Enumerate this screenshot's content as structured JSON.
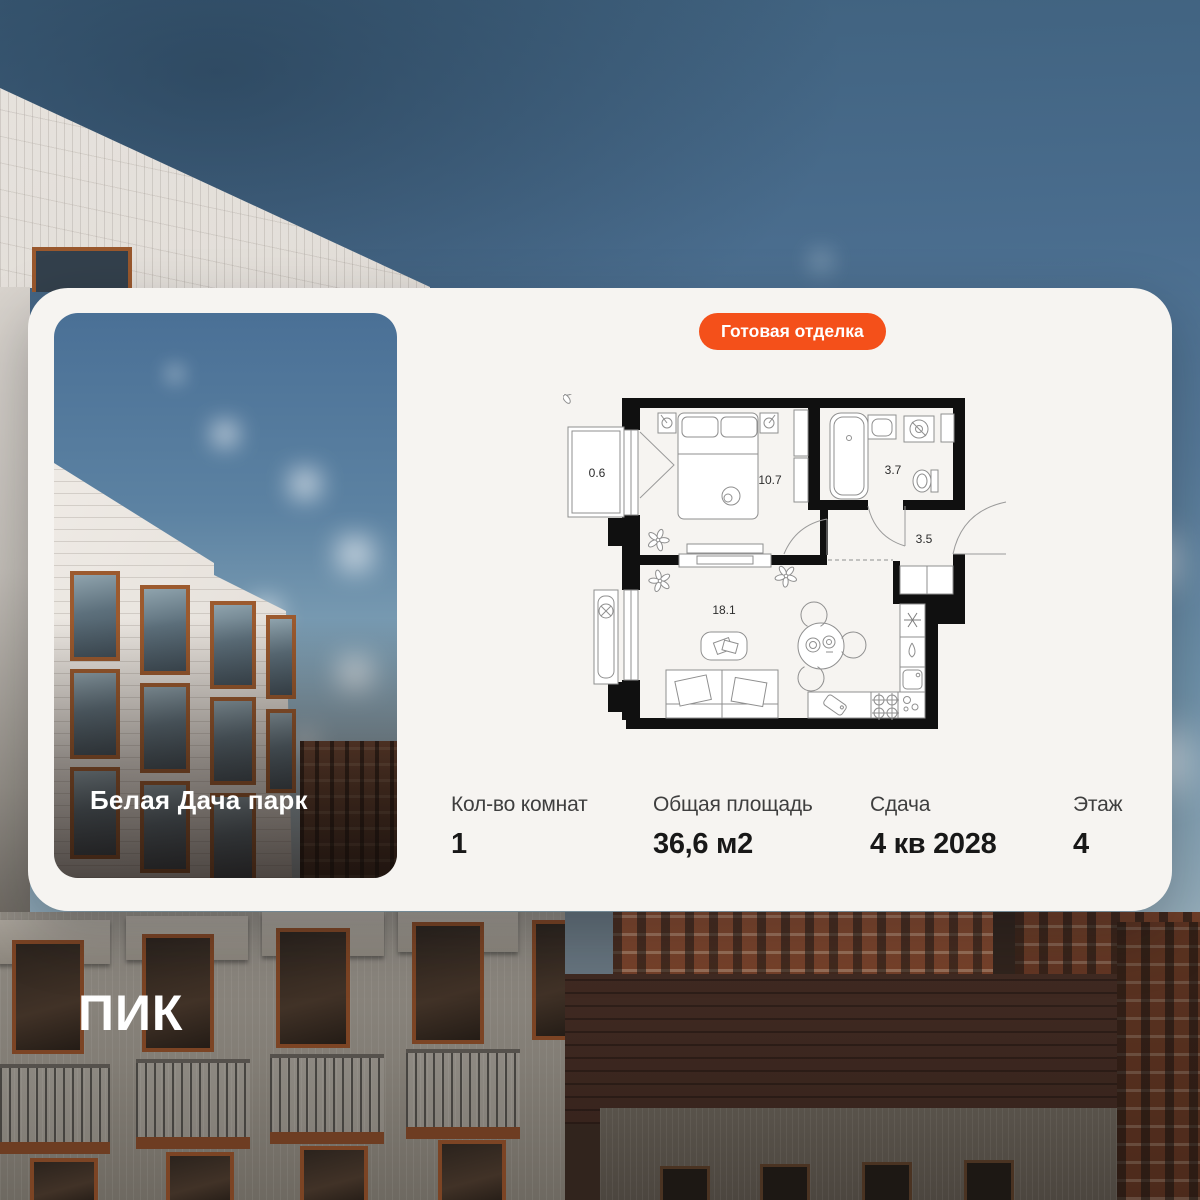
{
  "card": {
    "badge": {
      "label": "Готовая отделка"
    },
    "photo": {
      "title": "Белая Дача парк"
    },
    "plan": {
      "rooms": [
        {
          "name": "balcony",
          "area": "0.6"
        },
        {
          "name": "bedroom",
          "area": "10.7"
        },
        {
          "name": "bathroom",
          "area": "3.7"
        },
        {
          "name": "hallway",
          "area": "3.5"
        },
        {
          "name": "living-kitchen",
          "area": "18.1"
        }
      ]
    },
    "stats": [
      {
        "label": "Кол-во комнат",
        "value": "1"
      },
      {
        "label": "Общая площадь",
        "value": "36,6 м2"
      },
      {
        "label": "Сдача",
        "value": "4 кв 2028"
      },
      {
        "label": "Этаж",
        "value": "4"
      }
    ]
  },
  "brand": {
    "logo": "ПИК"
  },
  "colors": {
    "accent": "#F4501A",
    "card_bg": "#F6F4F1"
  }
}
